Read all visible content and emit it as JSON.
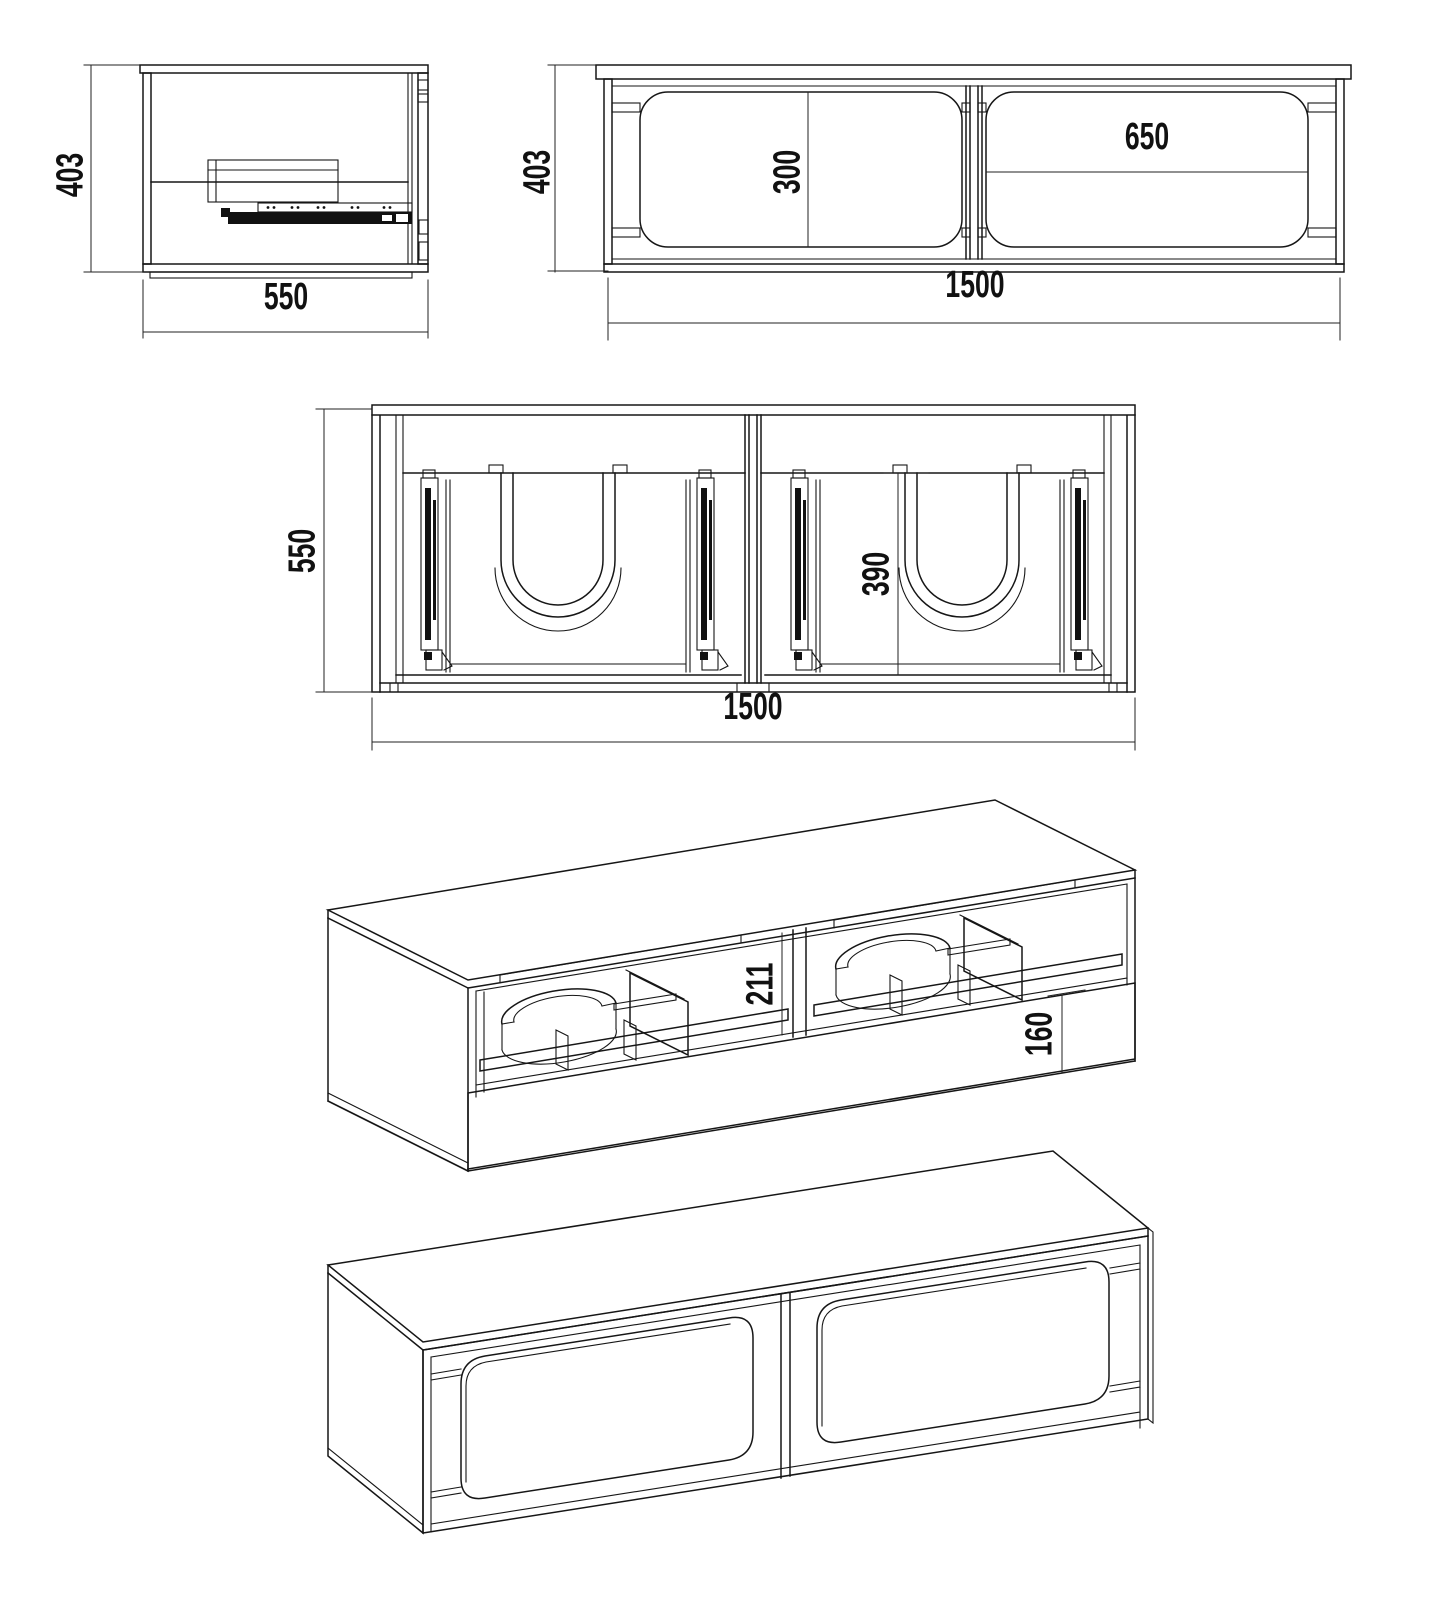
{
  "views": {
    "side": {
      "height": "403",
      "depth": "550"
    },
    "front": {
      "height": "403",
      "width": "1500",
      "panel_height": "300",
      "panel_width": "650"
    },
    "plan": {
      "depth": "550",
      "width": "1500",
      "basin_depth": "390"
    },
    "iso_open": {
      "opening_height": "211",
      "drawer_front_height": "160"
    }
  }
}
